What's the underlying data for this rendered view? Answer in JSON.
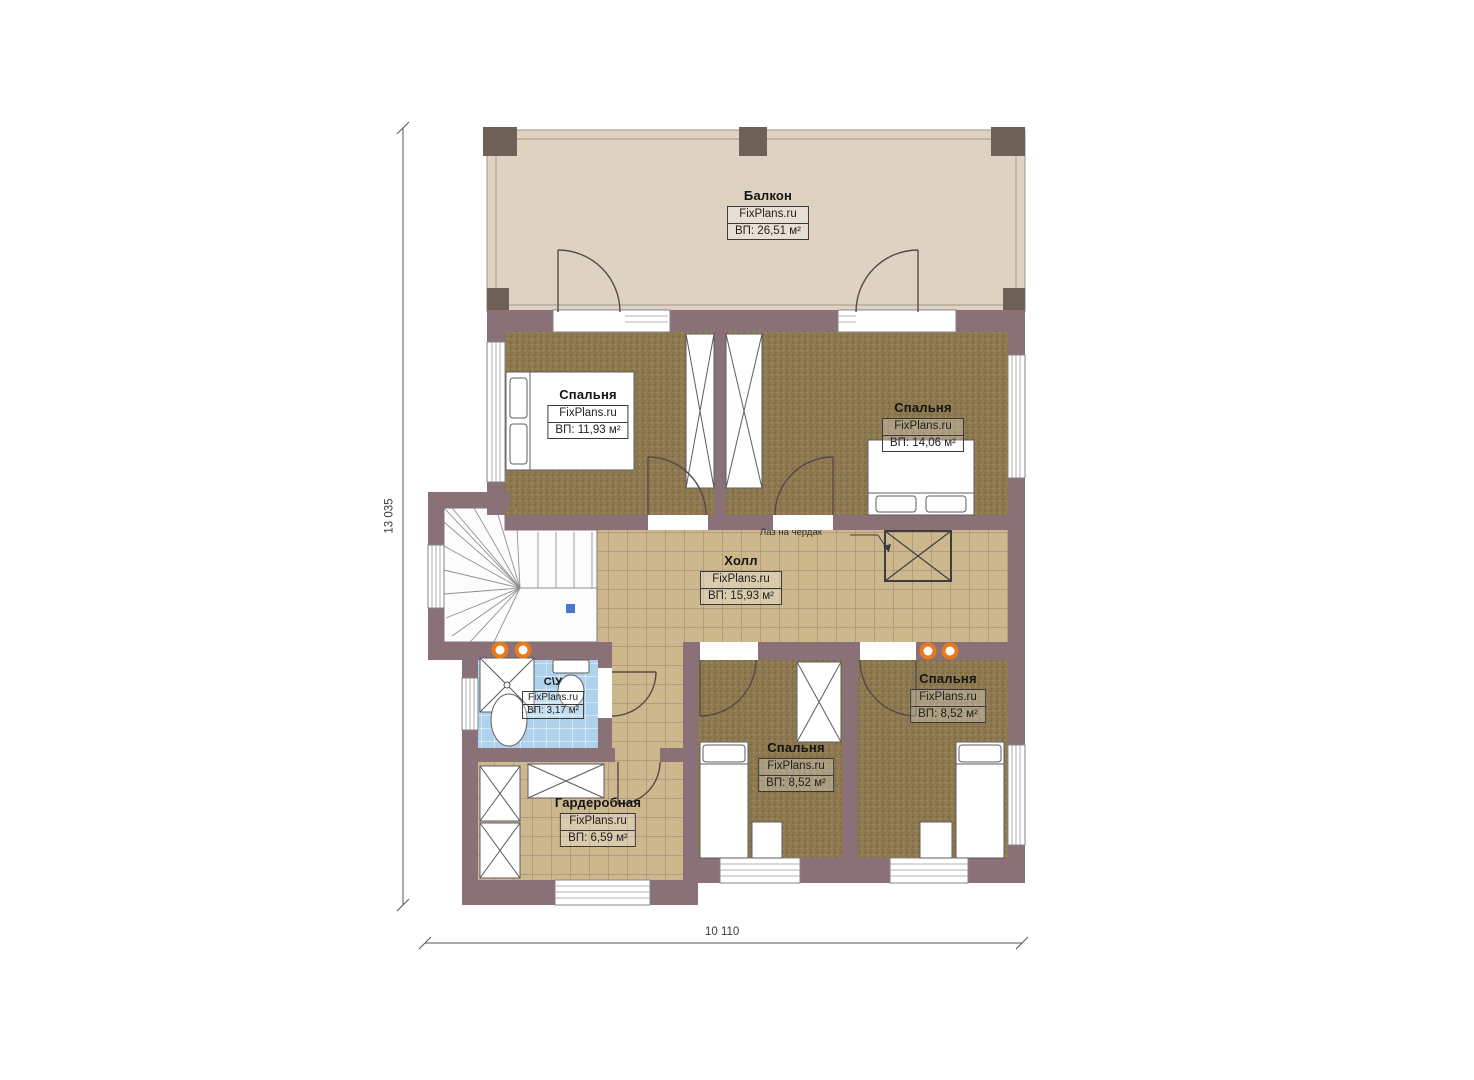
{
  "brand": "FixPlans.ru",
  "rooms": [
    {
      "id": "balcony",
      "name": "Балкон",
      "area": "ВП: 26,51 м²"
    },
    {
      "id": "bedroom-top-left",
      "name": "Спальня",
      "area": "ВП: 11,93 м²"
    },
    {
      "id": "bedroom-top-right",
      "name": "Спальня",
      "area": "ВП: 14,06 м²"
    },
    {
      "id": "hall",
      "name": "Холл",
      "area": "ВП: 15,93 м²"
    },
    {
      "id": "bathroom",
      "name": "С\\У",
      "area": "ВП: 3,17 м²"
    },
    {
      "id": "bedroom-bottom-right",
      "name": "Спальня",
      "area": "ВП: 8,52 м²"
    },
    {
      "id": "bedroom-bottom-middle",
      "name": "Спальня",
      "area": "ВП: 8,52 м²"
    },
    {
      "id": "wardrobe",
      "name": "Гардеробная",
      "area": "ВП: 6,59 м²"
    }
  ],
  "annotations": {
    "attic_hatch": "Лаз на чердак"
  },
  "dimensions": {
    "height": "13 035",
    "width": "10 110"
  },
  "colors": {
    "wall": "#8a7177",
    "carpet": "#8d784f",
    "tile": "#cdb88e",
    "bath_tile": "#aed2ec",
    "balcony_floor": "#ded3c2",
    "pillar": "#6e6057",
    "accent_orange": "#e87a1e"
  }
}
